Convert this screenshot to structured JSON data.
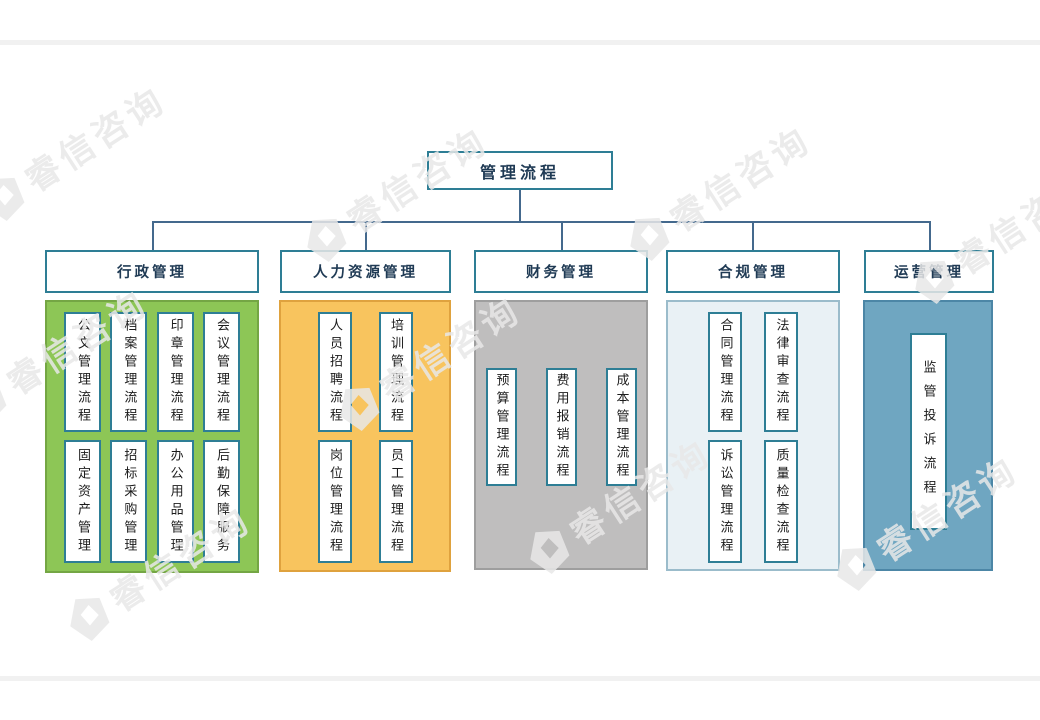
{
  "page": {
    "watermark_text": "睿信咨询"
  },
  "diagram": {
    "root": {
      "label": "管理流程"
    },
    "line_color": "#44698D",
    "box_border_color": "#2E7E95",
    "branches": [
      {
        "label": "行政管理",
        "fill": "#8DC656",
        "border": "#74A644",
        "items": [
          [
            "公文管理流程",
            "档案管理流程",
            "印章管理流程",
            "会议管理流程"
          ],
          [
            "固定资产管理",
            "招标采购管理",
            "办公用品管理",
            "后勤保障服务"
          ]
        ]
      },
      {
        "label": "人力资源管理",
        "fill": "#F8C45E",
        "border": "#DFA23E",
        "items": [
          [
            "人员招聘流程",
            "培训管理流程"
          ],
          [
            "岗位管理流程",
            "员工管理流程"
          ]
        ]
      },
      {
        "label": "财务管理",
        "fill": "#BFBEBE",
        "border": "#9E9E9E",
        "items": [
          [
            "预算管理流程",
            "费用报销流程",
            "成本管理流程"
          ]
        ]
      },
      {
        "label": "合规管理",
        "fill": "#E9F1F5",
        "border": "#9BBCCB",
        "items": [
          [
            "合同管理流程",
            "法律审查流程"
          ],
          [
            "诉讼管理流程",
            "质量检查流程"
          ]
        ]
      },
      {
        "label": "运营管理",
        "fill": "#6FA6C1",
        "border": "#4C86A6",
        "items": [
          [
            "监管投诉流程"
          ]
        ]
      }
    ]
  }
}
